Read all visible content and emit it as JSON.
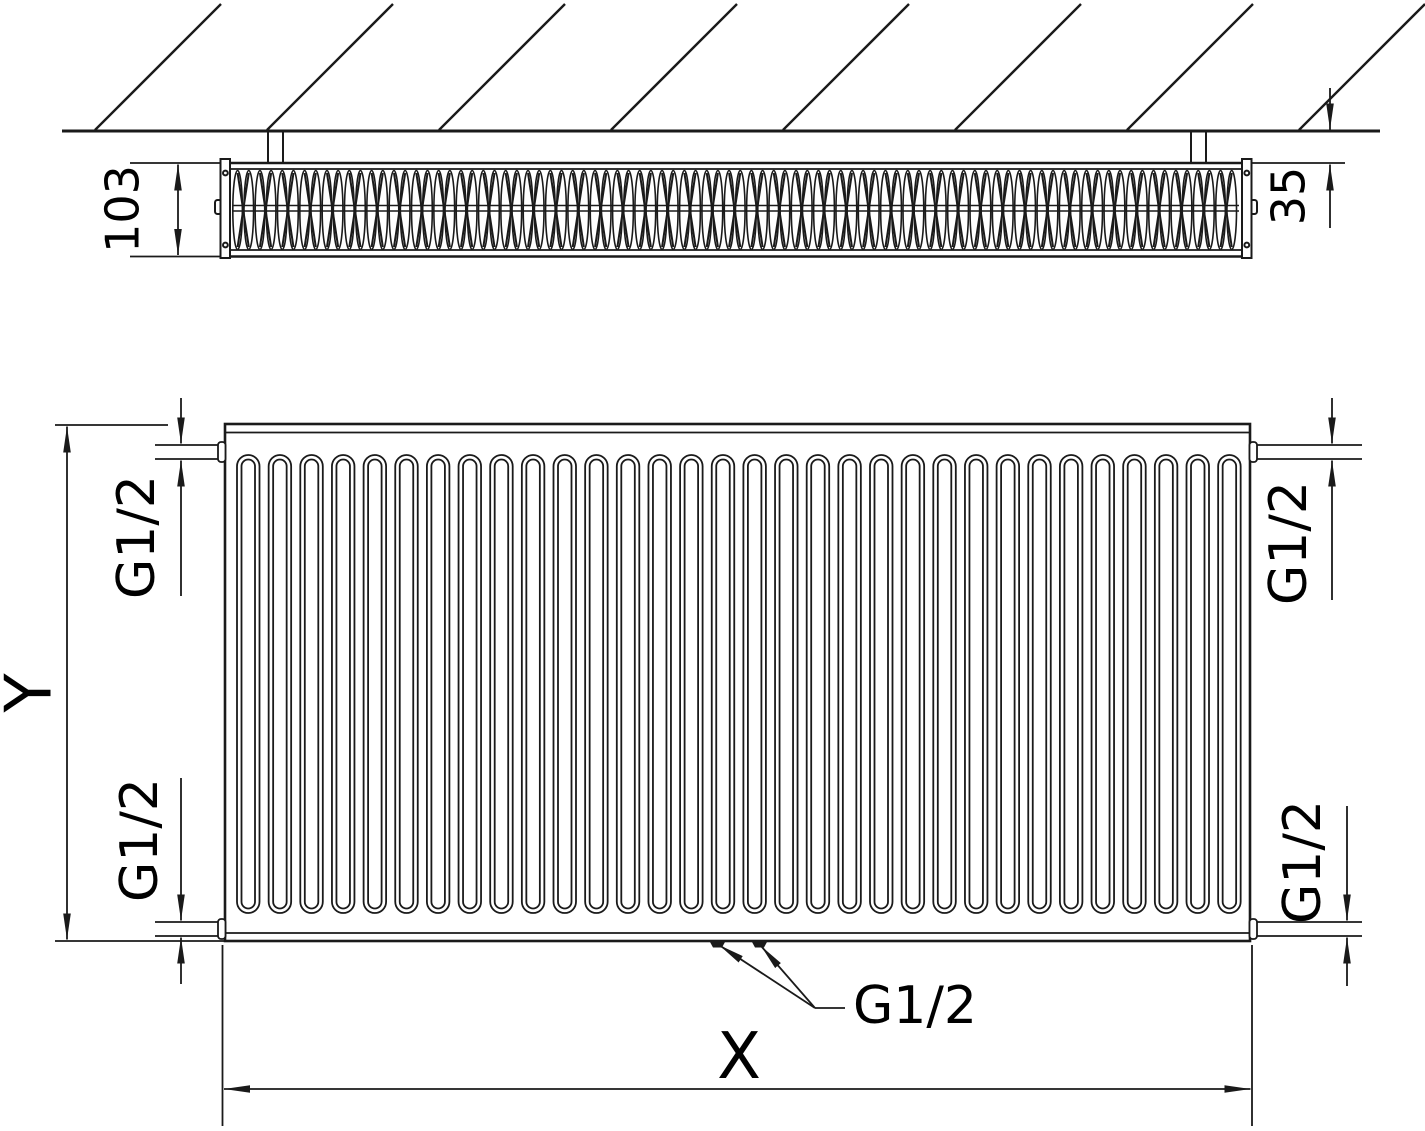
{
  "drawing": {
    "title": "panel-radiator-dimension-drawing",
    "colors": {
      "line": "#1a1a1a",
      "background": "#ffffff",
      "text": "#000000"
    },
    "labels": {
      "depth": "103",
      "wall_clearance": "35",
      "height_axis": "Y",
      "width_axis": "X",
      "connection_top_left": "G1/2",
      "connection_bottom_left": "G1/2",
      "connection_top_right": "G1/2",
      "connection_bottom_right": "G1/2",
      "connection_bottom_center": "G1/2"
    }
  }
}
